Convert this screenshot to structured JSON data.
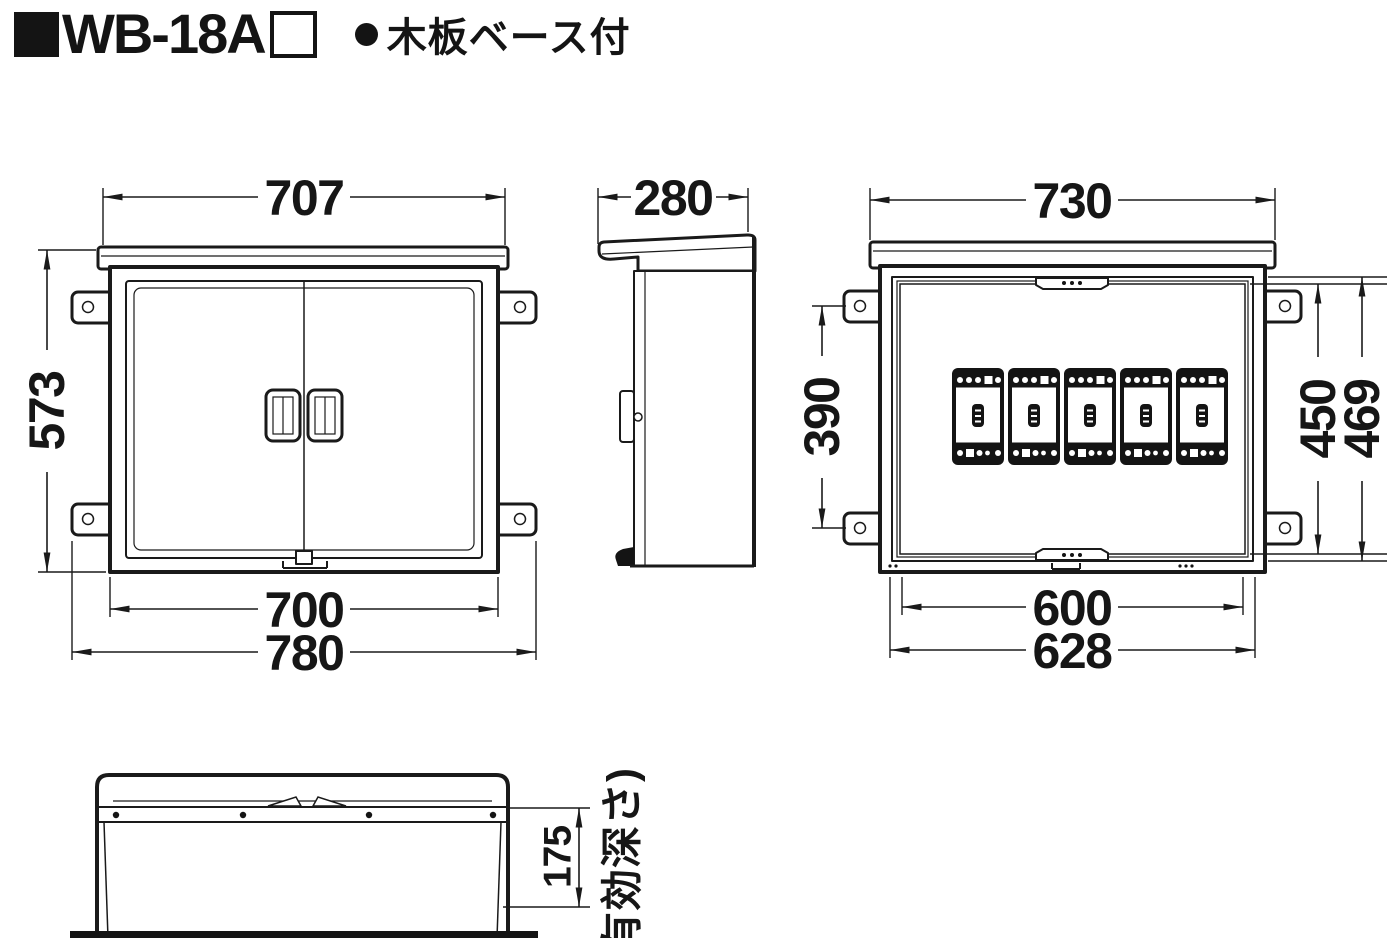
{
  "header": {
    "model": "WB-18A",
    "note": "木板ベース付"
  },
  "front_view": {
    "dim_top_width": "707",
    "dim_height": "573",
    "dim_body_width": "700",
    "dim_overall_width": "780"
  },
  "side_view": {
    "dim_depth": "280"
  },
  "base_view": {
    "dim_top_width": "730",
    "dim_mount_pitch": "390",
    "dim_board_height": "450",
    "dim_frame_height": "469",
    "dim_board_width": "600",
    "dim_frame_width": "628",
    "board_color": "#d7e8d0",
    "breaker_count": 5
  },
  "bottom_view": {
    "dim_effective_depth": "175",
    "label_effective_depth": "(有効深さ)"
  }
}
